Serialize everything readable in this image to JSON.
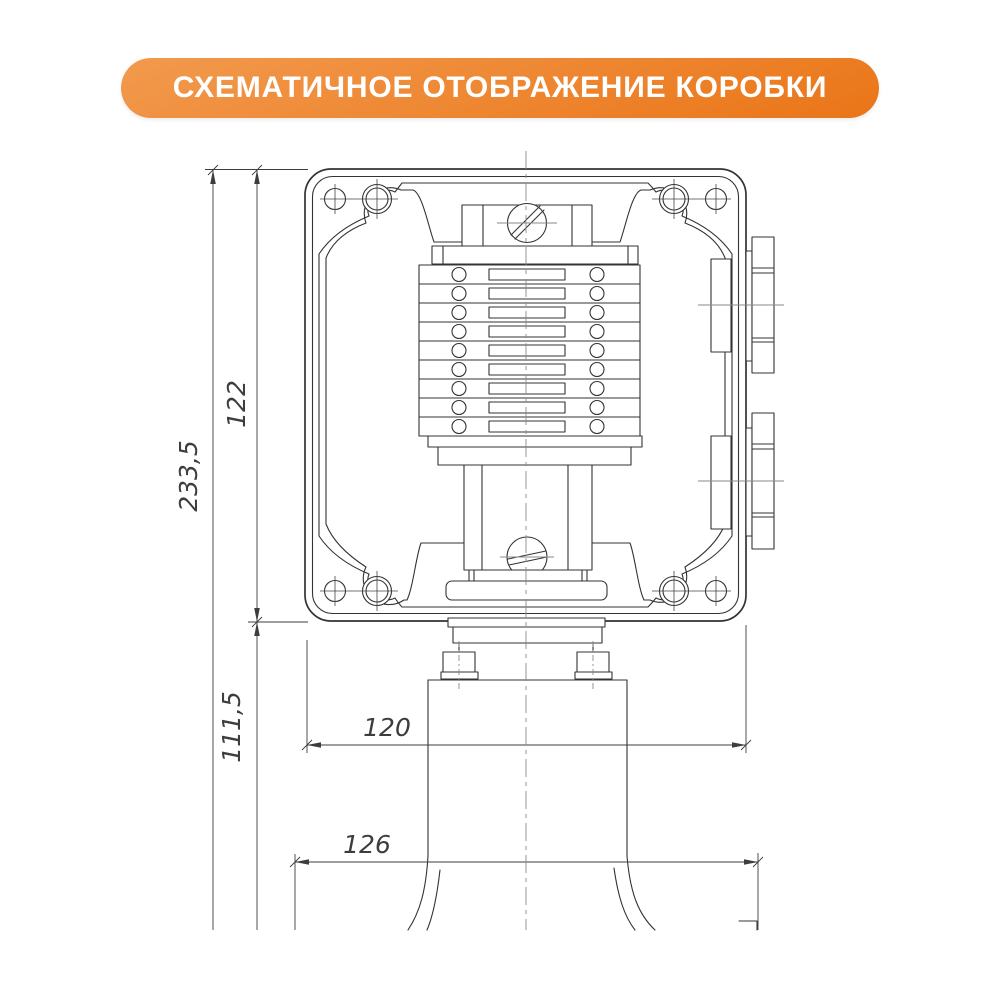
{
  "banner": {
    "title": "СХЕМАТИЧНОЕ ОТОБРАЖЕНИЕ КОРОБКИ",
    "bg_gradient_top": "#f29a4e",
    "bg_gradient_bottom": "#ea7517",
    "text_color": "#ffffff"
  },
  "drawing": {
    "line_color": "#333333",
    "centerline_color": "#8a8a8a",
    "dim_color": "#3d3d3d",
    "terminal_rows": 9,
    "dimensions": {
      "total_height": "233,5",
      "box_height": "122",
      "lower_section": "111,5",
      "flange_width": "120",
      "bottom_width": "126"
    }
  }
}
